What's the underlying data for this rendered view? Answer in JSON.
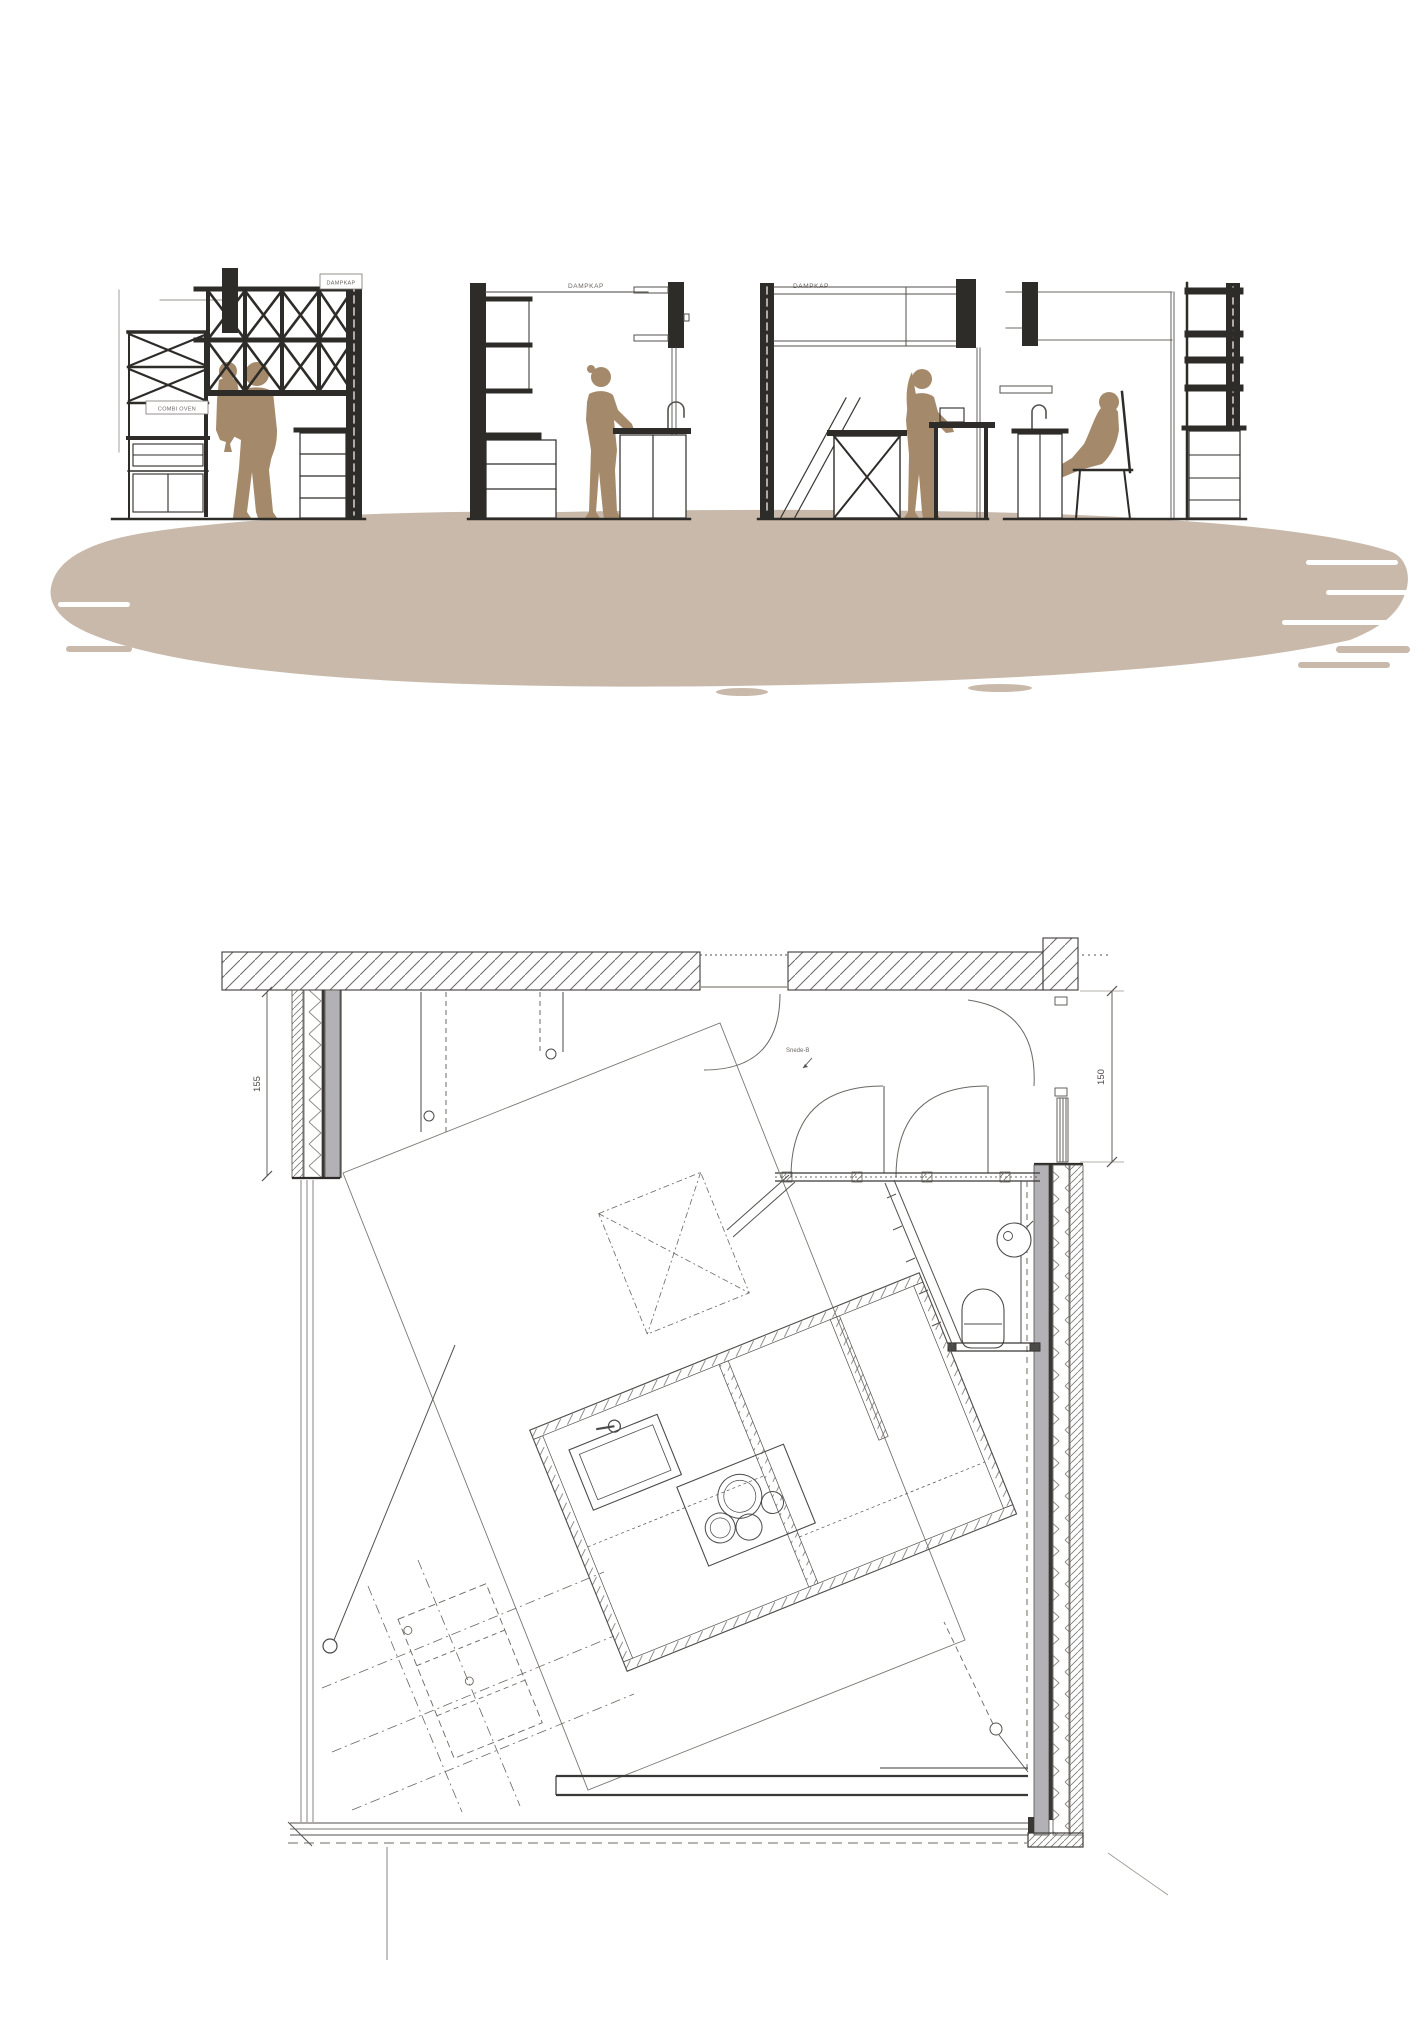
{
  "elevations": {
    "section1": {
      "hood_label": "DAMPKAP",
      "oven_label": "COMBI OVEN"
    },
    "section2": {
      "hood_label": "DAMPKAP"
    },
    "section3": {
      "hood_label": "DAMPKAP"
    }
  },
  "floor_plan": {
    "dim_left_wall": "155",
    "dim_right_wall": "150",
    "annotation": "Snede-B"
  },
  "palette": {
    "ink": "#2e2c29",
    "figure_brown": "#a5896b",
    "ground_wash": "#c8b9ab",
    "wall_gray": "#b2b1b6",
    "plan_line": "#4a4a48"
  }
}
